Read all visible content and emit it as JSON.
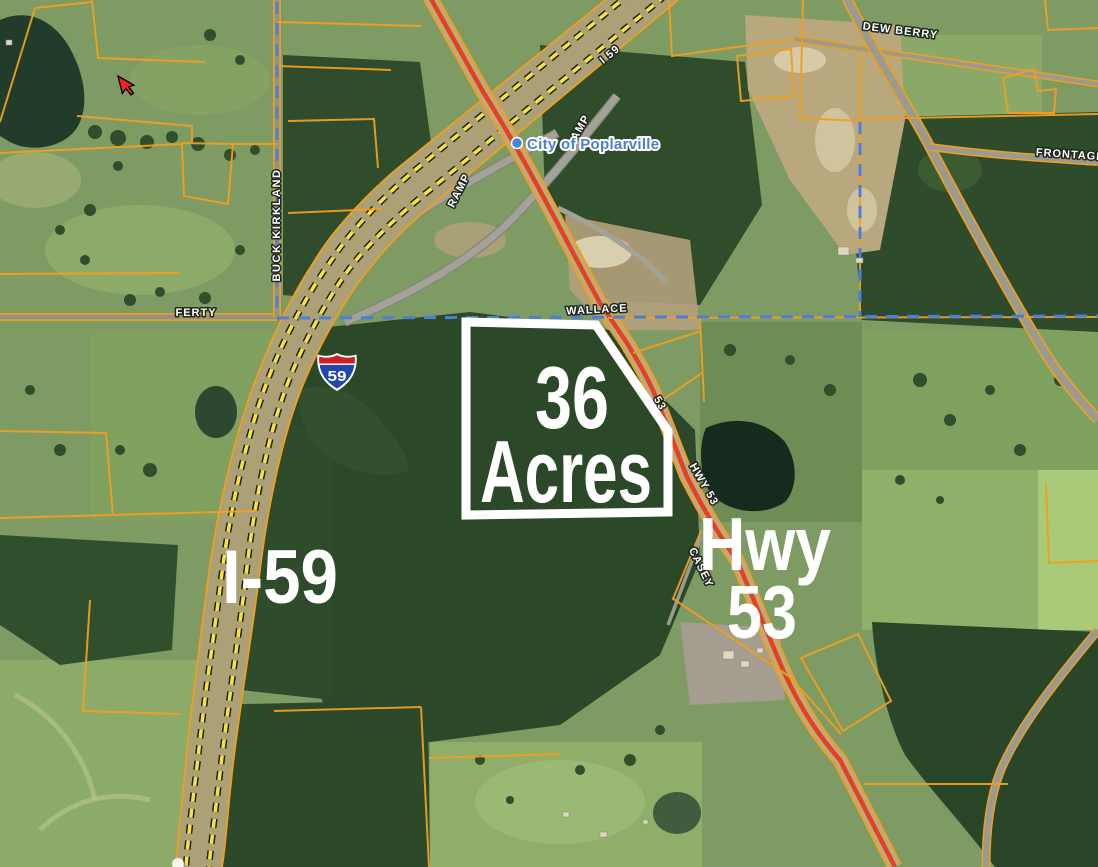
{
  "map": {
    "type": "satellite-parcel-map",
    "labels": {
      "acreage": {
        "line1": "36",
        "line2": "Acres"
      },
      "interstate": "I-59",
      "highway": {
        "line1": "Hwy",
        "line2": "53"
      }
    },
    "shield": {
      "number": "59"
    },
    "roads": {
      "ramp_west": "RAMP",
      "ramp_east": "RAMP",
      "interstate_route": "I 59",
      "wallace": "WALLACE",
      "ferty": "FERTY",
      "buck_kirkland": "BUCK KIRKLAND",
      "dew_berry": "DEW BERRY",
      "frontage": "FRONTAGE",
      "hwy53_upper": "53",
      "hwy53": "HWY 53",
      "casey": "CASEY"
    },
    "place": {
      "city": "City of Poplarville"
    },
    "colors": {
      "parcel_line": "#ef9f1f",
      "highway_red": "#e8401c",
      "interstate_dash": "#f8e33c",
      "city_boundary_blue": "#4a7fdc",
      "place_text_blue": "#4b7fd0",
      "overlay_text": "#ffffff",
      "property_outline": "#ffffff",
      "field_green": "#7d9b63",
      "forest_green": "#2c4a2a",
      "dirt_tan": "#b9a77d"
    }
  }
}
